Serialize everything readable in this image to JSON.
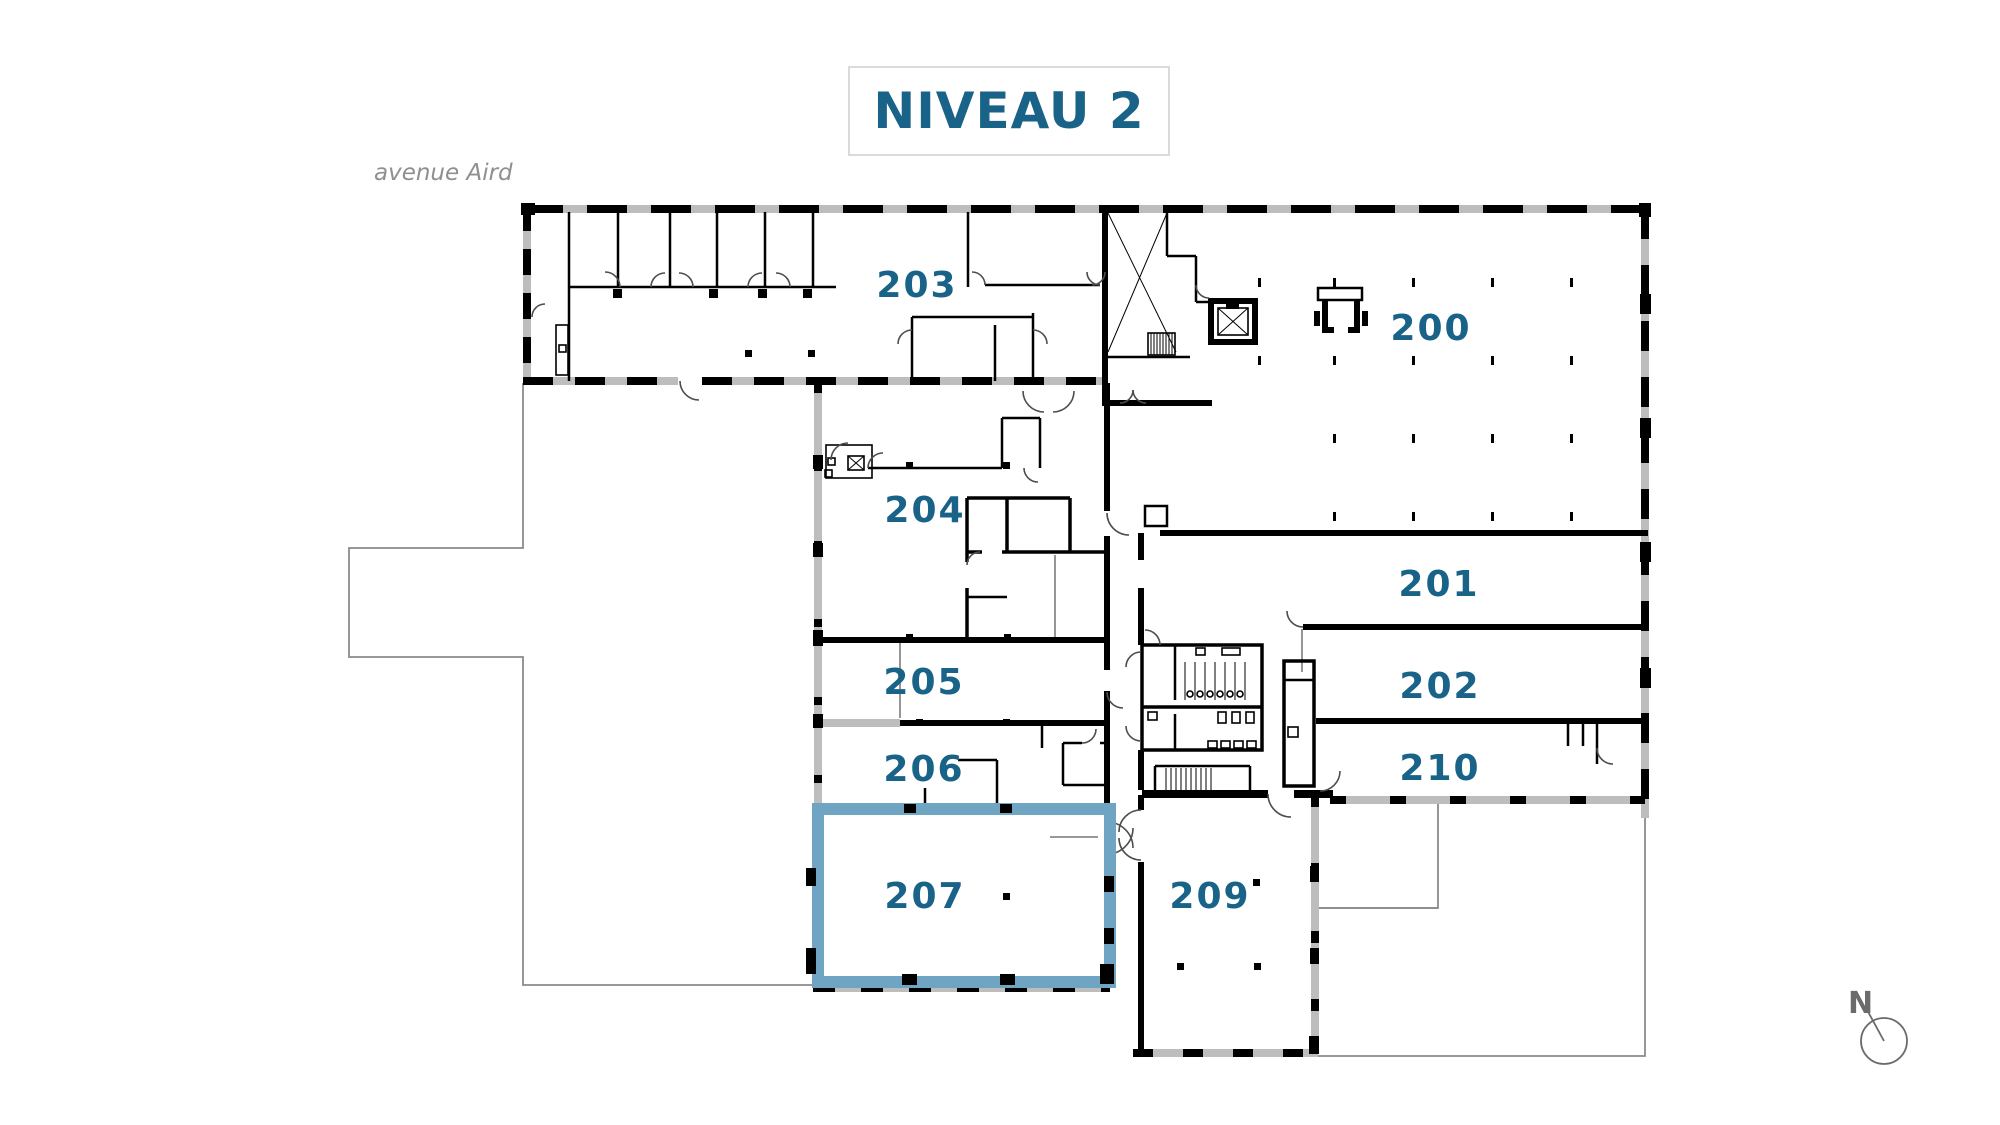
{
  "title": "NIVEAU 2",
  "street_label": "avenue Aird",
  "compass_label": "N",
  "highlighted_room": "207",
  "colors": {
    "label_teal": "#186387",
    "highlight_blue": "#6FA5C2",
    "wall_black": "#000000",
    "window_gray": "#BDBDBD",
    "outline_gray": "#8A8A8A",
    "title_border": "#DADADA",
    "street_gray": "#8F8F8F",
    "compass_gray": "#6B6B6B"
  },
  "rooms": {
    "r200": "200",
    "r201": "201",
    "r202": "202",
    "r203": "203",
    "r204": "204",
    "r205": "205",
    "r206": "206",
    "r207": "207",
    "r209": "209",
    "r210": "210"
  }
}
